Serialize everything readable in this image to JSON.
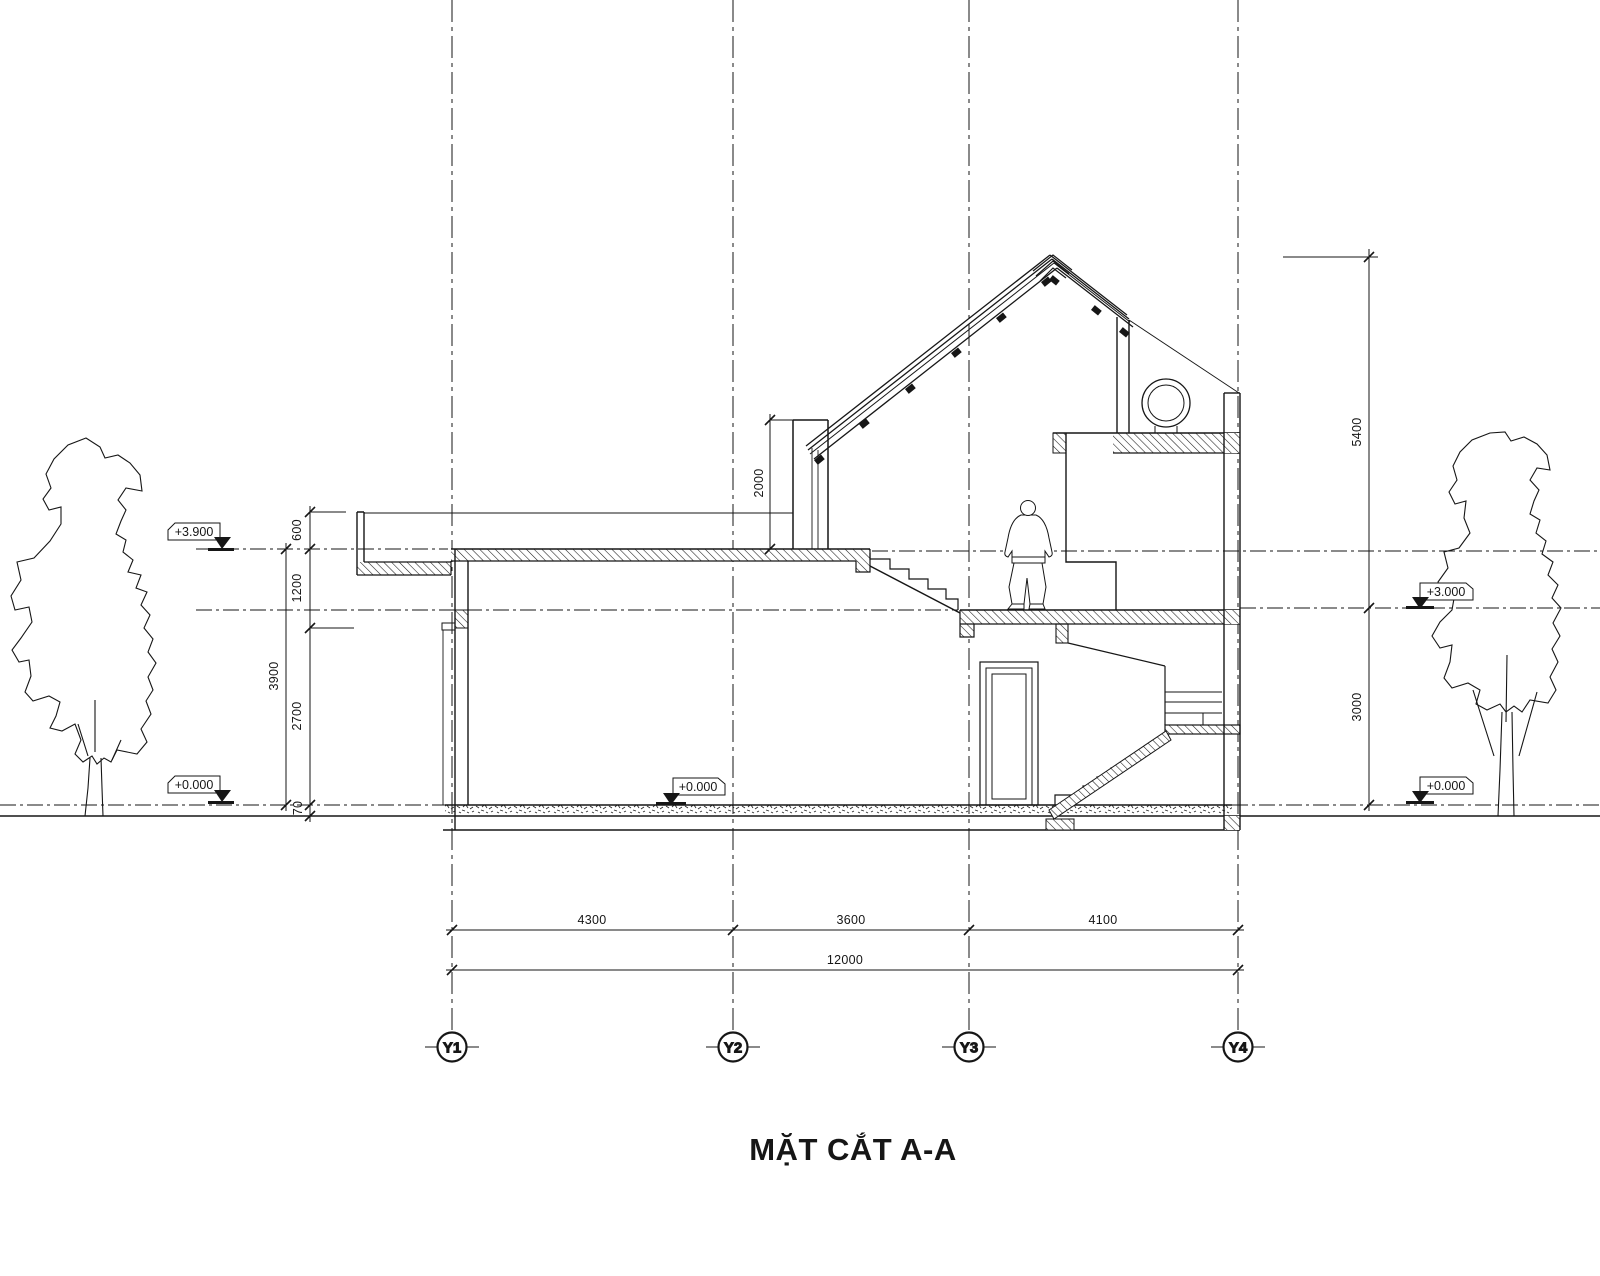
{
  "title": "MẶT CẮT A-A",
  "grid_bubbles": [
    "Y1",
    "Y2",
    "Y3",
    "Y4"
  ],
  "dimensions": {
    "bottom_segments": [
      "4300",
      "3600",
      "4100"
    ],
    "bottom_total": "12000",
    "left": {
      "parapet": "600",
      "upper": "1200",
      "storey": "3900",
      "lower": "2700",
      "plinth": "70"
    },
    "right": {
      "roof": "5400",
      "storey": "3000"
    },
    "clerestory_height": "2000"
  },
  "levels": {
    "left_upper": "+3.900",
    "left_ground": "+0.000",
    "interior_ground": "+0.000",
    "right_upper": "+3.000",
    "right_ground": "+0.000"
  },
  "colors": {
    "line": "#161616",
    "background": "#ffffff"
  }
}
